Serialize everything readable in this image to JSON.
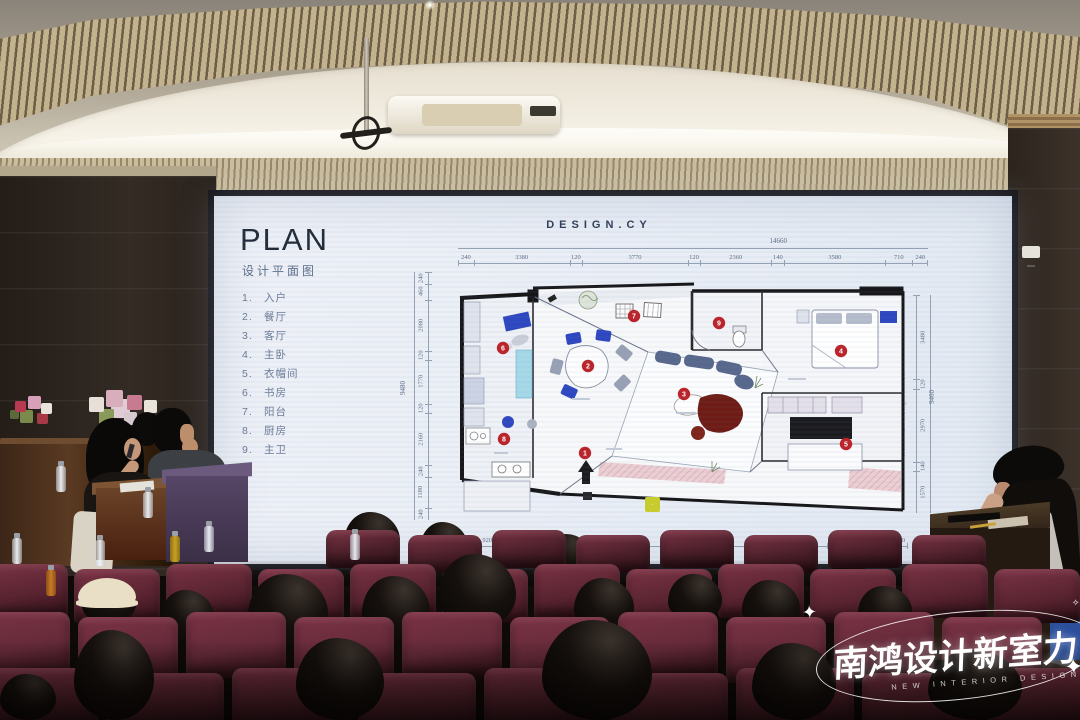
{
  "slide": {
    "title": "PLAN",
    "subtitle": "设计平面图",
    "legend": [
      {
        "num": "1.",
        "label": "入户"
      },
      {
        "num": "2.",
        "label": "餐厅"
      },
      {
        "num": "3.",
        "label": "客厅"
      },
      {
        "num": "4.",
        "label": "主卧"
      },
      {
        "num": "5.",
        "label": "衣帽间"
      },
      {
        "num": "6.",
        "label": "书房"
      },
      {
        "num": "7.",
        "label": "阳台"
      },
      {
        "num": "8.",
        "label": "厨房"
      },
      {
        "num": "9.",
        "label": "主卫"
      }
    ],
    "plan_title": "DESIGN.CY",
    "dims": {
      "top_total": "14660",
      "top": [
        "240",
        "3380",
        "120",
        "3770",
        "120",
        "2360",
        "140",
        "3580",
        "710",
        "240"
      ],
      "bottom": [
        "240",
        "920",
        "240",
        "2100",
        "4380",
        "120",
        "4380",
        "240",
        "1560",
        "240"
      ],
      "left_total": "9480",
      "left": [
        "240",
        "460",
        "2080",
        "120",
        "1770",
        "120",
        "2160",
        "240",
        "1180",
        "240"
      ],
      "right_total": "9460",
      "right": [
        "3480",
        "120",
        "2970",
        "140",
        "1570"
      ]
    },
    "markers": [
      "1",
      "2",
      "3",
      "4",
      "5",
      "6",
      "7",
      "8",
      "9"
    ],
    "watermark_url": "www.nan-hong.com.cn"
  },
  "brand": {
    "name": "南鸿设计新室力",
    "tagline": "NEW INTERIOR DESIGN"
  },
  "colors": {
    "marker_red": "#bb2328",
    "chair_blue": "#2e47c0",
    "seat_maroon": "#5a2431",
    "rug_dark_red": "#6e1c15",
    "counter_cyan": "#a6d9e8"
  }
}
